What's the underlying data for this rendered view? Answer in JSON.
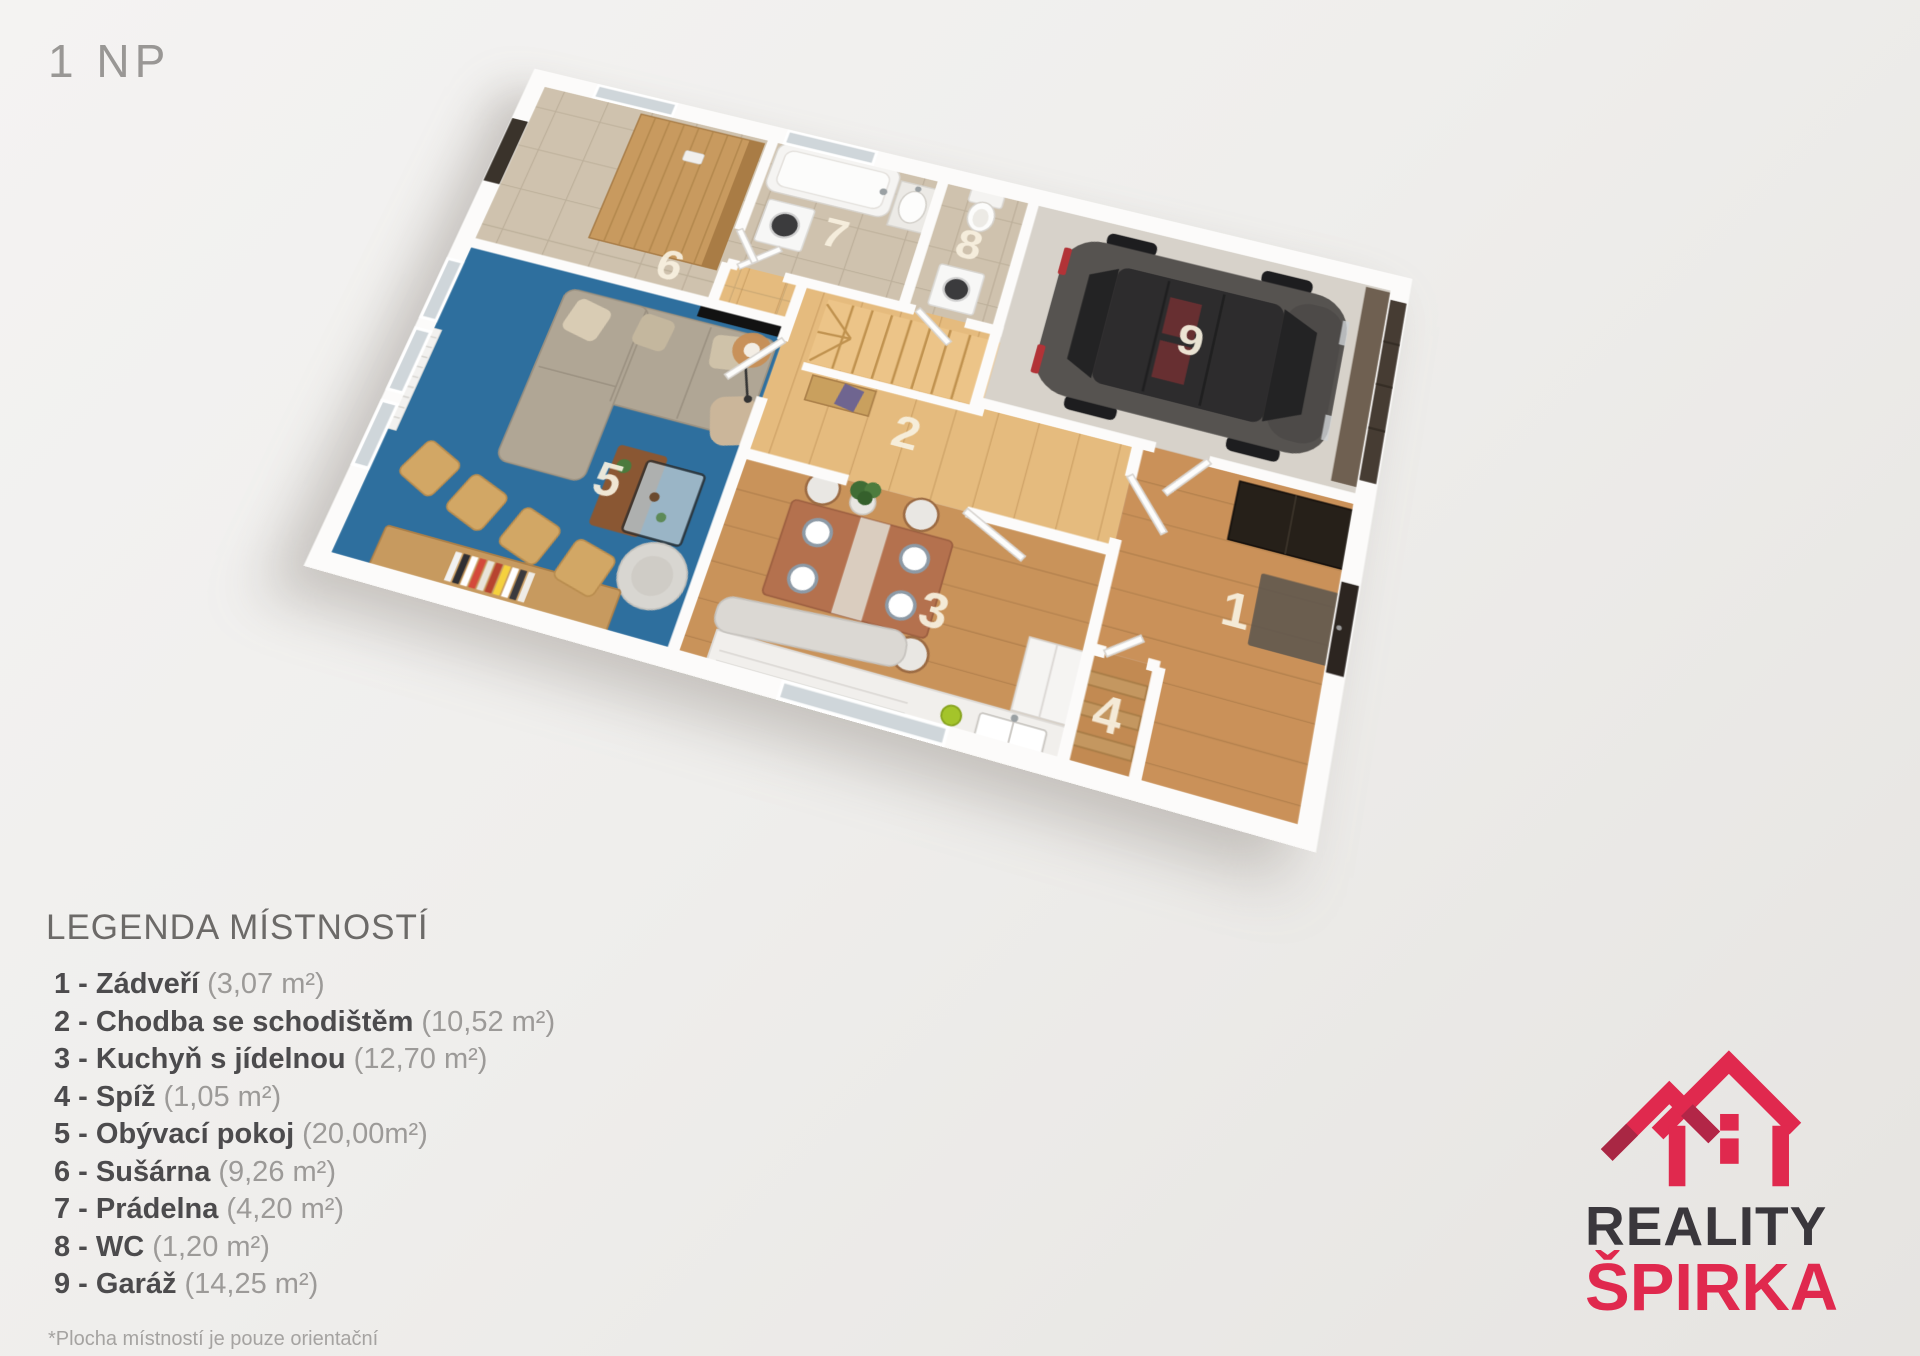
{
  "page": {
    "floor_label": "1 NP"
  },
  "legend": {
    "title": "LEGENDA MÍSTNOSTÍ",
    "items": [
      {
        "label": "1 - Zádveří",
        "area": "(3,07 m²)"
      },
      {
        "label": "2 - Chodba se schodištěm",
        "area": "(10,52 m²)"
      },
      {
        "label": "3 - Kuchyň s jídelnou",
        "area": "(12,70 m²)"
      },
      {
        "label": "4 - Spíž",
        "area": "(1,05 m²)"
      },
      {
        "label": "5 - Obývací pokoj",
        "area": "(20,00m²)"
      },
      {
        "label": "6 - Sušárna",
        "area": "(9,26 m²)"
      },
      {
        "label": "7 - Prádelna",
        "area": "(4,20 m²)"
      },
      {
        "label": "8 - WC",
        "area": "(1,20 m²)"
      },
      {
        "label": "9 - Garáž",
        "area": "(14,25 m²)"
      }
    ],
    "note": "*Plocha místností je pouze orientační"
  },
  "rooms": [
    {
      "number": "1",
      "name": "Zádveří"
    },
    {
      "number": "2",
      "name": "Chodba se schodištěm"
    },
    {
      "number": "3",
      "name": "Kuchyň s jídelnou"
    },
    {
      "number": "4",
      "name": "Spíž"
    },
    {
      "number": "5",
      "name": "Obývací pokoj"
    },
    {
      "number": "6",
      "name": "Sušárna"
    },
    {
      "number": "7",
      "name": "Prádelna"
    },
    {
      "number": "8",
      "name": "WC"
    },
    {
      "number": "9",
      "name": "Garáž"
    }
  ],
  "logo": {
    "line1": "REALITY",
    "line2": "ŠPIRKA"
  },
  "colors": {
    "background": "#efeeec",
    "brand_red": "#e0294e",
    "brand_dark": "#3a373c",
    "carpet_blue": "#2e6f9e",
    "tile_beige": "#cfc2ae",
    "wood_hall": "#e5bb7e",
    "wood_kitchen": "#c9935a",
    "garage_concrete": "#d7d2ca",
    "wall_white": "#fcfbfa",
    "car_gray": "#565350"
  }
}
